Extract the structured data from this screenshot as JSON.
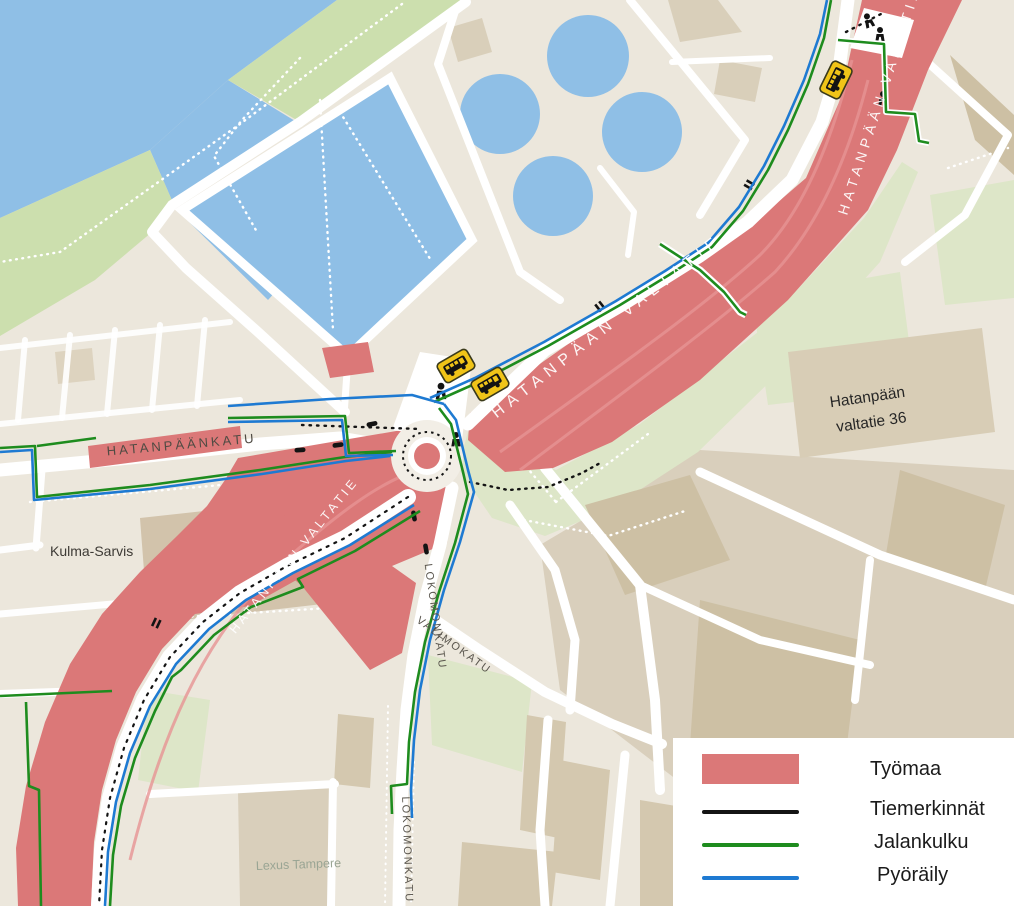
{
  "map": {
    "street_labels": [
      {
        "text": "HATANPÄÄNKATU"
      },
      {
        "text": "HATANPÄÄN VALTATIE"
      },
      {
        "text": "HATANPÄÄN VALTATIE"
      },
      {
        "text": "HATANPÄÄN VALTATIE"
      },
      {
        "text": "LOKOMONKATU"
      },
      {
        "text": "VALIMOKATU"
      },
      {
        "text": "LOKOMONKATU"
      }
    ],
    "place_labels": {
      "kulma_sarvis": "Kulma-Sarvis",
      "lexus": "Lexus Tampere",
      "hatanpaan_36_line1": "Hatanpään",
      "hatanpaan_36_line2": "valtatie 36"
    }
  },
  "legend": {
    "items": [
      {
        "label": "Työmaa",
        "type": "area",
        "color": "#db7878"
      },
      {
        "label": "Tiemerkinnät",
        "type": "line",
        "color": "#141414"
      },
      {
        "label": "Jalankulku",
        "type": "line",
        "color": "#1e8c1e"
      },
      {
        "label": "Pyöräily",
        "type": "line",
        "color": "#1e7ad2"
      }
    ]
  },
  "colors": {
    "construction_zone": "#db7878",
    "road_markings": "#141414",
    "pedestrian_route": "#1e8c1e",
    "cycling_route": "#1e7ad2",
    "water": "#8fbfe6",
    "park_green": "#ccdfae",
    "bus_stop_yellow": "#f0c418",
    "background": "#ece7dc"
  },
  "icons": [
    {
      "name": "bus-stop-icon",
      "count": 3
    },
    {
      "name": "pedestrian-icon"
    },
    {
      "name": "vehicle-marking-icon"
    },
    {
      "name": "roundabout"
    }
  ]
}
